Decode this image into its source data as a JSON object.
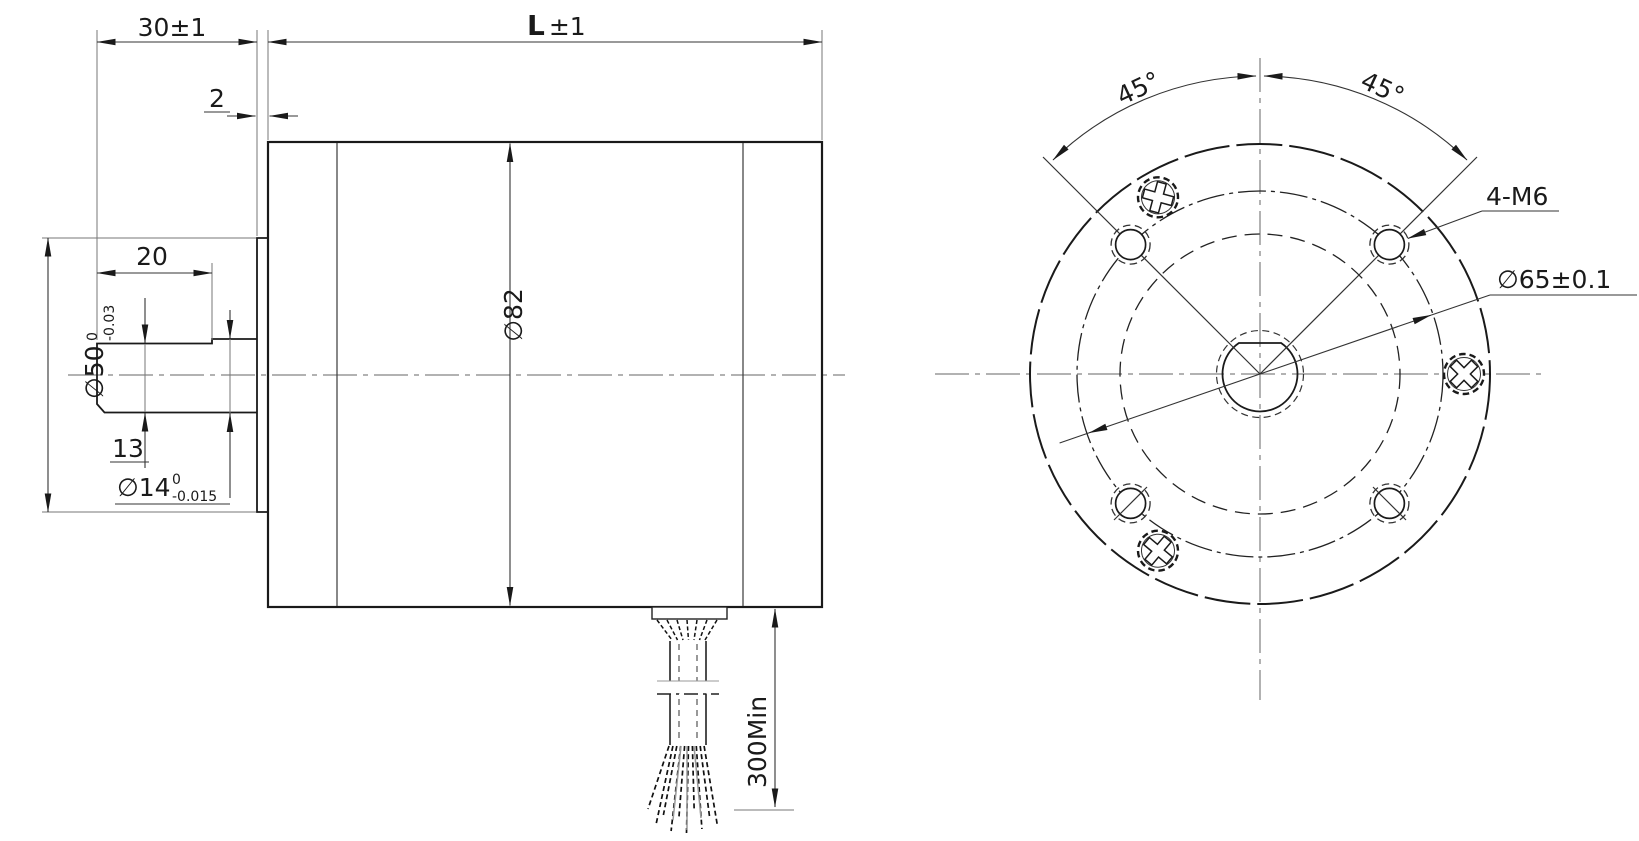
{
  "drawing": {
    "side_view": {
      "dim_shaft_extension": "30±1",
      "dim_body_length_main": "L",
      "dim_body_length_tol": "±1",
      "dim_boss_protrusion": "2",
      "dim_flat_length": "20",
      "dim_body_od": "∅82",
      "dim_flat_height": "13",
      "pilot_diameter": "∅50",
      "pilot_tol_upper": "0",
      "pilot_tol_lower": "-0.03",
      "shaft_diameter": "∅14",
      "shaft_tol_upper": "0",
      "shaft_tol_lower": "-0.015",
      "dim_cable_length": "300Min"
    },
    "front_view": {
      "dim_angle_left": "45°",
      "dim_angle_right": "45°",
      "label_mount_holes": "4-M6",
      "dim_bolt_circle": "∅65±0.1"
    },
    "line_color": "#1a1a1a",
    "background": "#ffffff"
  }
}
